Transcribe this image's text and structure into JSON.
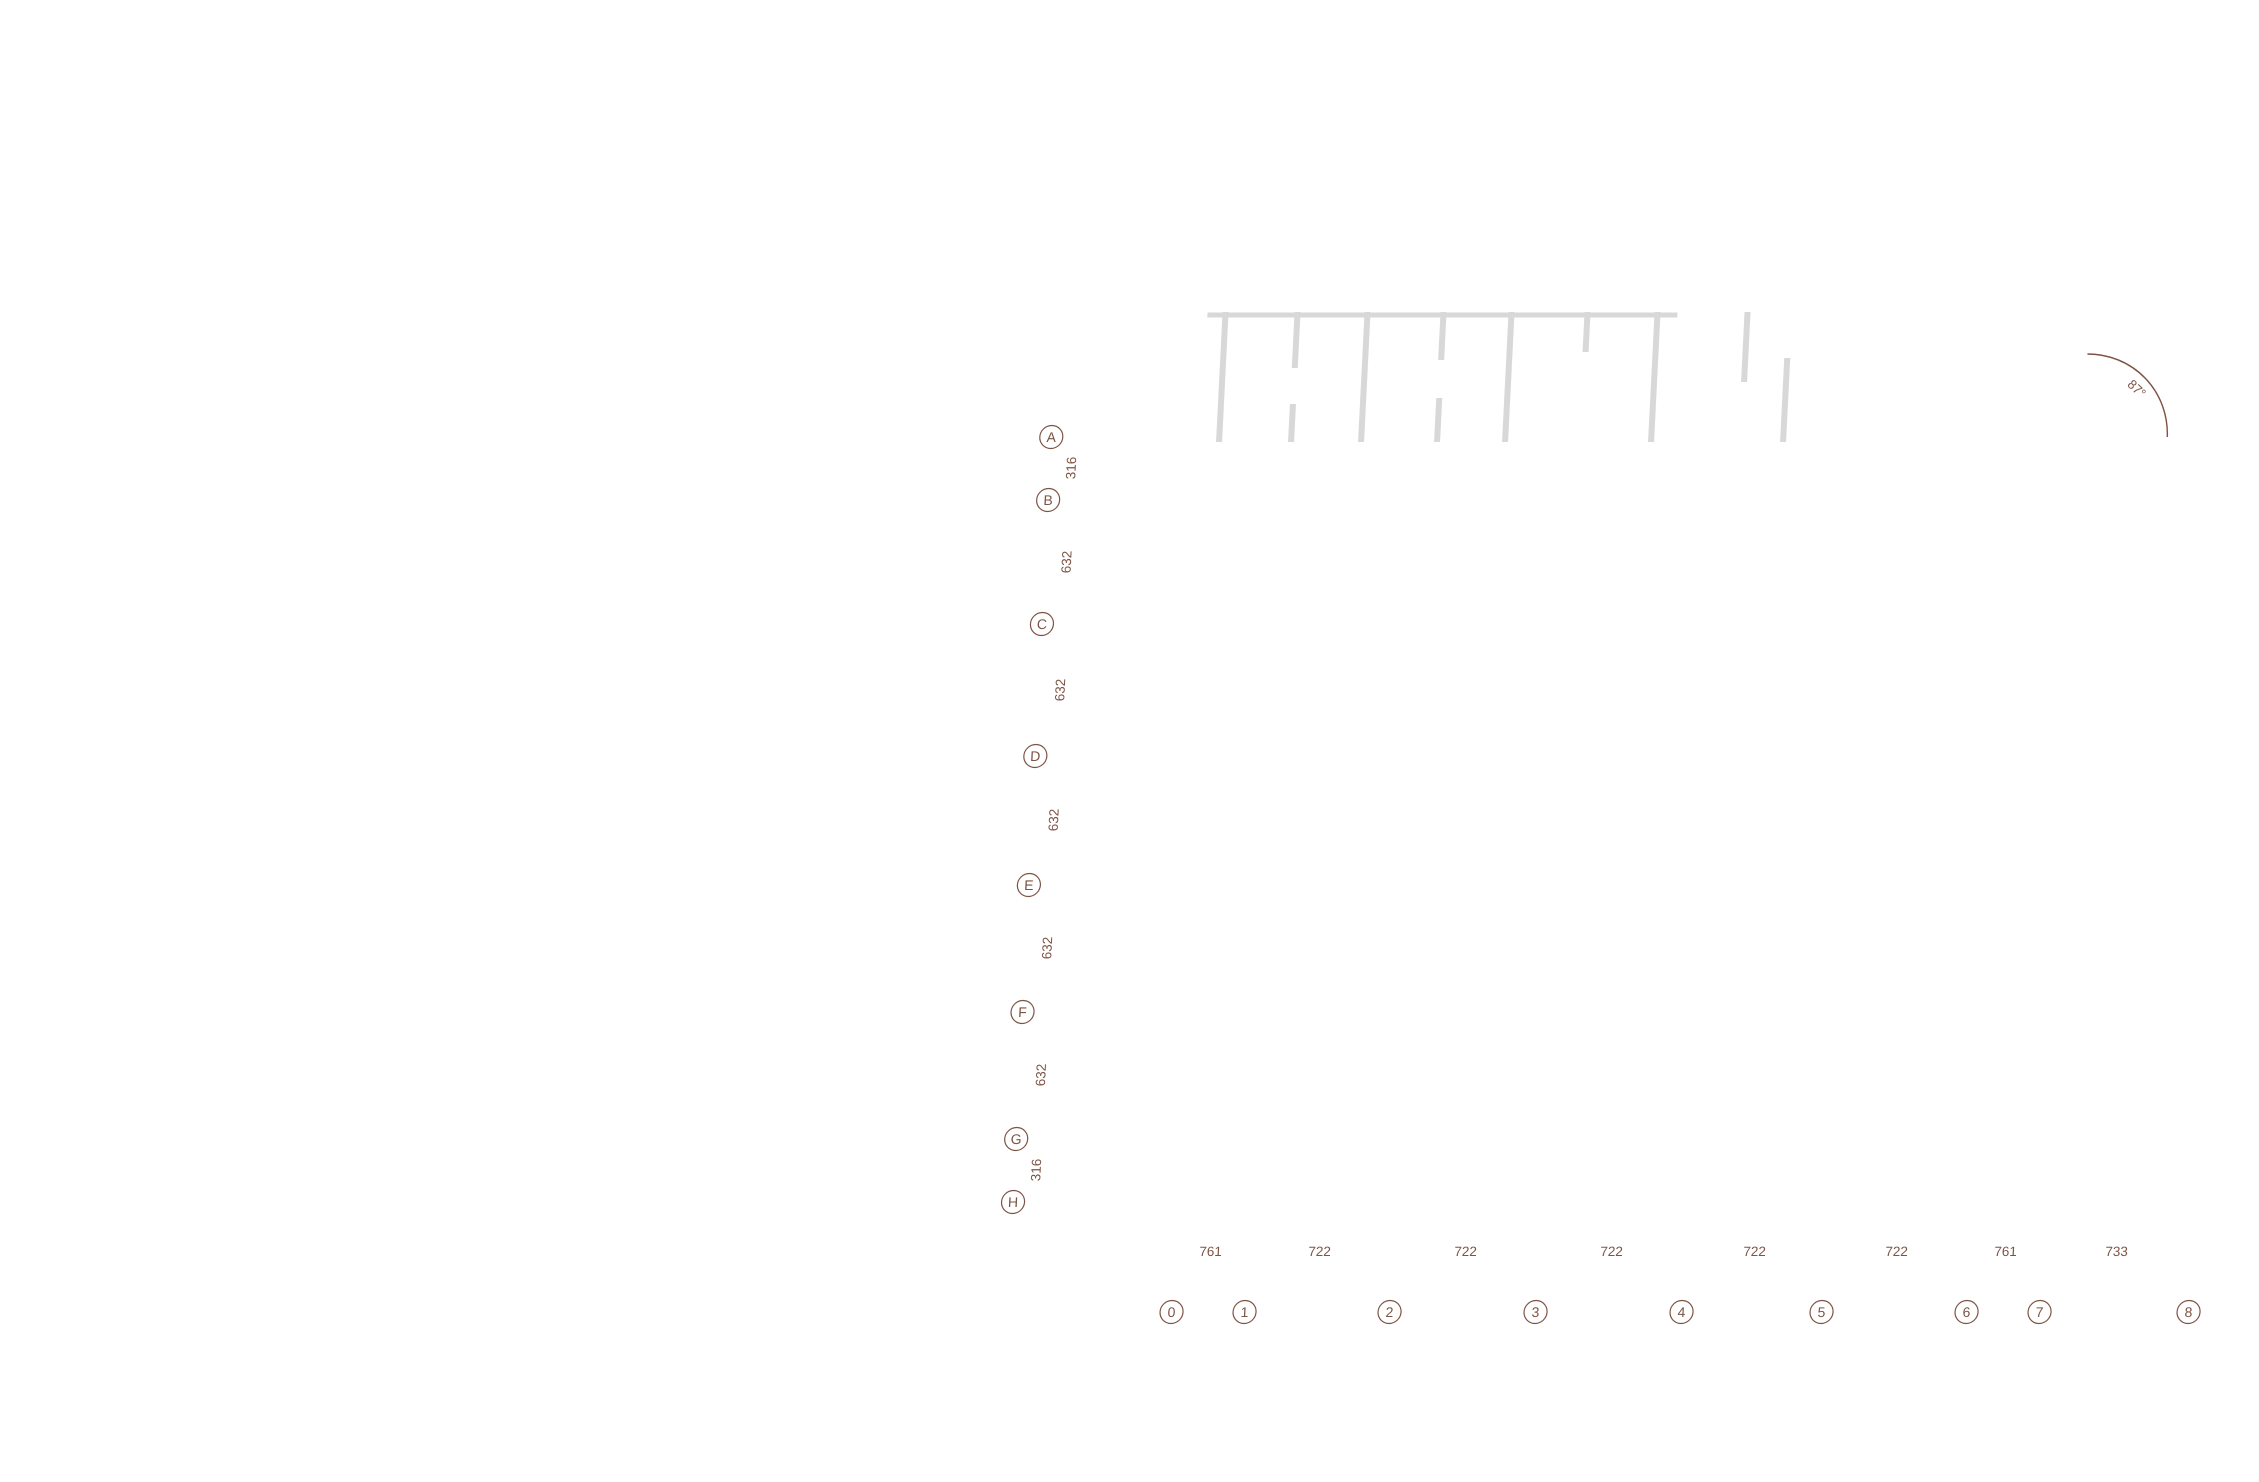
{
  "drawing": {
    "grid": {
      "rows": [
        "A",
        "B",
        "C",
        "D",
        "E",
        "F",
        "G",
        "H"
      ],
      "row_dims": [
        "316",
        "632",
        "632",
        "632",
        "632",
        "632",
        "316"
      ],
      "cols": [
        "0",
        "1",
        "2",
        "3",
        "4",
        "5",
        "6",
        "7",
        "8"
      ],
      "col_dims": [
        "761",
        "722",
        "722",
        "722",
        "722",
        "722",
        "761",
        "733"
      ],
      "angle_label": "87°"
    },
    "colors": {
      "grid_line": "#7d5343",
      "circulation": "#b7b7b7",
      "terrace": "#e9e9e9",
      "context": "#d8d8d8",
      "wall": "#1c1c1c",
      "courtyard": "#fdfcf6",
      "vegetation_green": "#7c9a53",
      "vegetation_accent": "#bd7d36"
    }
  }
}
